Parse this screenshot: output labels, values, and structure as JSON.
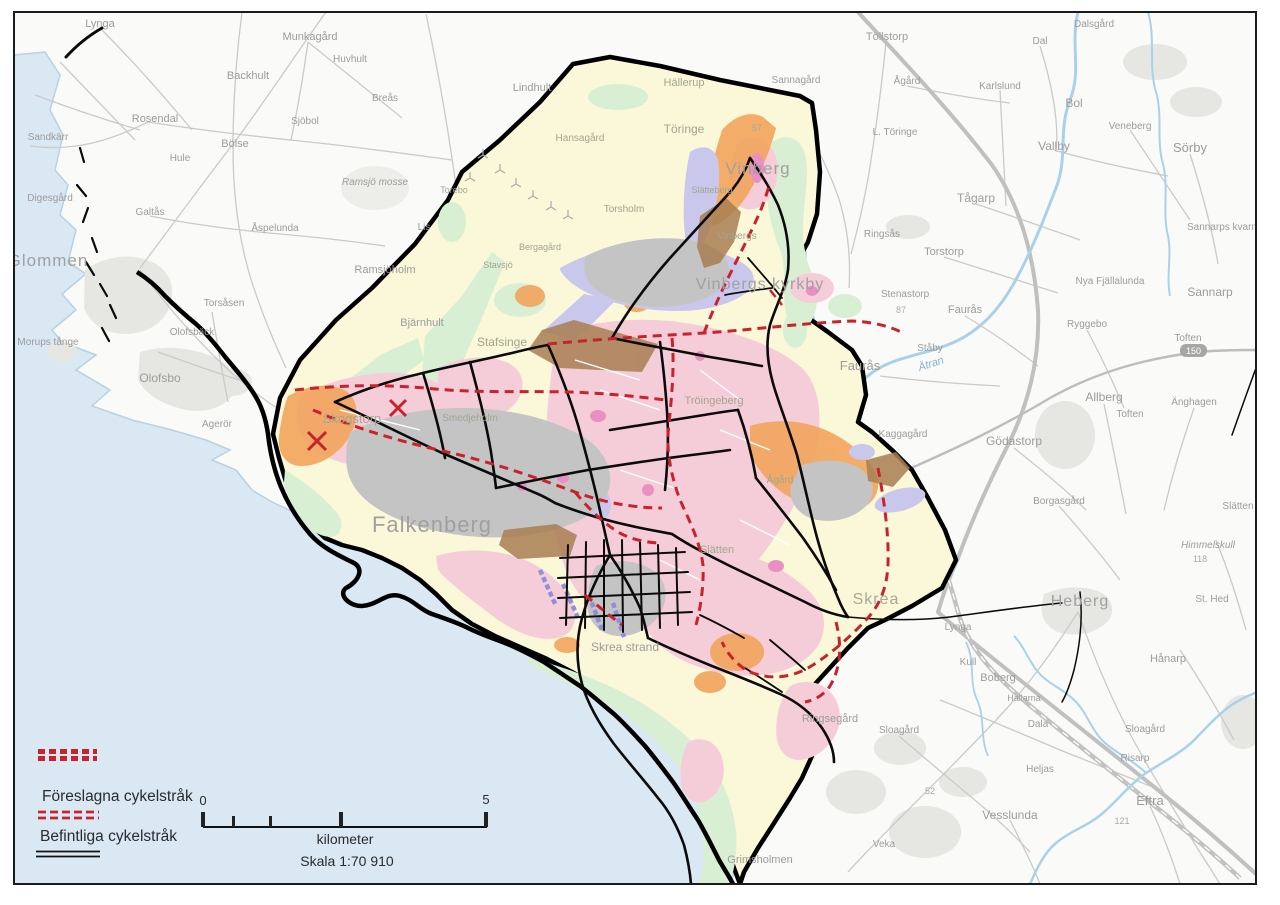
{
  "legend": {
    "items": [
      {
        "id": "proposed",
        "label": "Föreslagna cykelstråk"
      },
      {
        "id": "existing",
        "label": "Befintliga cykelstråk"
      }
    ]
  },
  "scalebar": {
    "start": "0",
    "end": "5",
    "unit": "kilometer",
    "scale": "Skala 1:70 910"
  },
  "road_shield": {
    "text": "150"
  },
  "colors": {
    "sea": "#d9e8f3",
    "coast": "#b7d2e3",
    "land": "#fafaf8",
    "planning_area": "#fbf7d9",
    "boundary": "#000000",
    "route_existing": "#0b0b0b",
    "route_proposed": "#c8232d",
    "pink_zone": "#f5cdd9",
    "magenta_zone": "#e98fc2",
    "green_zone": "#d9efd4",
    "orange_zone": "#f2a45c",
    "lavender_zone": "#c9c8ec",
    "gray_zone": "#c4c4c4",
    "brown_zone": "#a87e52",
    "river": "#a9d2e9",
    "road": "#cacaca",
    "road_major": "#bdbdbd",
    "urban": "#e6e6e3",
    "pier_violet": "#8f8ed8",
    "frame": "#1b1b1b"
  },
  "places": [
    {
      "t": "Lynga",
      "x": 100,
      "y": 27,
      "s": 11,
      "k": "out"
    },
    {
      "t": "Munkagård",
      "x": 310,
      "y": 40,
      "s": 11,
      "k": "out"
    },
    {
      "t": "Huvhult",
      "x": 350,
      "y": 62,
      "s": 10,
      "k": "out"
    },
    {
      "t": "Backhult",
      "x": 248,
      "y": 79,
      "s": 11,
      "k": "out"
    },
    {
      "t": "Breås",
      "x": 385,
      "y": 101,
      "s": 10,
      "k": "out"
    },
    {
      "t": "Lindhult",
      "x": 532,
      "y": 91,
      "s": 11,
      "k": "out"
    },
    {
      "t": "Rosendal",
      "x": 155,
      "y": 122,
      "s": 11,
      "k": "out"
    },
    {
      "t": "Sjöbol",
      "x": 305,
      "y": 124,
      "s": 10,
      "k": "out"
    },
    {
      "t": "Sandkärr",
      "x": 48,
      "y": 140,
      "s": 10,
      "k": "out"
    },
    {
      "t": "Bölse",
      "x": 235,
      "y": 147,
      "s": 11,
      "k": "out"
    },
    {
      "t": "Hule",
      "x": 180,
      "y": 161,
      "s": 10,
      "k": "out"
    },
    {
      "t": "Ramsjö mosse",
      "x": 375,
      "y": 185,
      "s": 10,
      "k": "out",
      "i": 1
    },
    {
      "t": "Digesgård",
      "x": 50,
      "y": 201,
      "s": 10,
      "k": "out"
    },
    {
      "t": "Galtås",
      "x": 150,
      "y": 215,
      "s": 10,
      "k": "out"
    },
    {
      "t": "Åspelunda",
      "x": 275,
      "y": 231,
      "s": 10,
      "k": "out"
    },
    {
      "t": "Glommen",
      "x": 48,
      "y": 266,
      "s": 17,
      "k": "big"
    },
    {
      "t": "Ramsjöholm",
      "x": 385,
      "y": 273,
      "s": 11,
      "k": "out"
    },
    {
      "t": "Lis",
      "x": 424,
      "y": 230,
      "s": 10,
      "k": "out"
    },
    {
      "t": "Torsåsen",
      "x": 224,
      "y": 306,
      "s": 10,
      "k": "out"
    },
    {
      "t": "Olofsbäck",
      "x": 192,
      "y": 335,
      "s": 10,
      "k": "out"
    },
    {
      "t": "Bjärnhult",
      "x": 422,
      "y": 326,
      "s": 11,
      "k": "out"
    },
    {
      "t": "Morups tånge",
      "x": 48,
      "y": 345,
      "s": 10,
      "k": "out"
    },
    {
      "t": "Olofsbo",
      "x": 160,
      "y": 382,
      "s": 12,
      "k": "out"
    },
    {
      "t": "Agerör",
      "x": 217,
      "y": 427,
      "s": 10,
      "k": "out"
    },
    {
      "t": "Töllstorp",
      "x": 887,
      "y": 40,
      "s": 11,
      "k": "out"
    },
    {
      "t": "Ågård",
      "x": 907,
      "y": 84,
      "s": 10,
      "k": "out"
    },
    {
      "t": "Dalsgård",
      "x": 1094,
      "y": 27,
      "s": 10,
      "k": "out"
    },
    {
      "t": "Dal",
      "x": 1040,
      "y": 44,
      "s": 10,
      "k": "out"
    },
    {
      "t": "Karlslund",
      "x": 1000,
      "y": 89,
      "s": 10,
      "k": "out"
    },
    {
      "t": "Bol",
      "x": 1074,
      "y": 107,
      "s": 12,
      "k": "out"
    },
    {
      "t": "L. Töringe",
      "x": 895,
      "y": 135,
      "s": 10,
      "k": "out"
    },
    {
      "t": "Vallby",
      "x": 1054,
      "y": 150,
      "s": 12,
      "k": "out"
    },
    {
      "t": "Veneberg",
      "x": 1130,
      "y": 129,
      "s": 10,
      "k": "out"
    },
    {
      "t": "Sörby",
      "x": 1190,
      "y": 152,
      "s": 13,
      "k": "out"
    },
    {
      "t": "Tågarp",
      "x": 976,
      "y": 202,
      "s": 12,
      "k": "out"
    },
    {
      "t": "Ringsås",
      "x": 882,
      "y": 237,
      "s": 10,
      "k": "out"
    },
    {
      "t": "Torstorp",
      "x": 944,
      "y": 255,
      "s": 11,
      "k": "out"
    },
    {
      "t": "Sannarps kvarn",
      "x": 1222,
      "y": 230,
      "s": 10,
      "k": "out"
    },
    {
      "t": "Sannarp",
      "x": 1210,
      "y": 296,
      "s": 12,
      "k": "out"
    },
    {
      "t": "Nya Fjällalunda",
      "x": 1110,
      "y": 284,
      "s": 10,
      "k": "out"
    },
    {
      "t": "Stenastorp",
      "x": 905,
      "y": 297,
      "s": 10,
      "k": "out"
    },
    {
      "t": "87",
      "x": 901,
      "y": 313,
      "s": 9,
      "k": "num"
    },
    {
      "t": "Faurås",
      "x": 965,
      "y": 313,
      "s": 11,
      "k": "out"
    },
    {
      "t": "Ståby",
      "x": 930,
      "y": 351,
      "s": 10,
      "k": "out"
    },
    {
      "t": "Faurås",
      "x": 860,
      "y": 370,
      "s": 13,
      "k": "out"
    },
    {
      "t": "Ryggebo",
      "x": 1087,
      "y": 327,
      "s": 10,
      "k": "out"
    },
    {
      "t": "Toften",
      "x": 1188,
      "y": 341,
      "s": 10,
      "k": "out"
    },
    {
      "t": "Ätran",
      "x": 932,
      "y": 367,
      "s": 11,
      "k": "riv",
      "r": -18
    },
    {
      "t": "Allberg",
      "x": 1104,
      "y": 401,
      "s": 12,
      "k": "out"
    },
    {
      "t": "Toften",
      "x": 1130,
      "y": 417,
      "s": 10,
      "k": "out"
    },
    {
      "t": "Änghagen",
      "x": 1194,
      "y": 405,
      "s": 10,
      "k": "out"
    },
    {
      "t": "Kaggagård",
      "x": 903,
      "y": 437,
      "s": 10,
      "k": "out"
    },
    {
      "t": "Gödastorp",
      "x": 1014,
      "y": 445,
      "s": 12,
      "k": "out"
    },
    {
      "t": "Borgasgård",
      "x": 1059,
      "y": 504,
      "s": 10,
      "k": "out"
    },
    {
      "t": "Slätten",
      "x": 1238,
      "y": 509,
      "s": 10,
      "k": "out"
    },
    {
      "t": "Himmelskull",
      "x": 1208,
      "y": 548,
      "s": 10,
      "k": "out",
      "i": 1
    },
    {
      "t": "118",
      "x": 1200,
      "y": 562,
      "s": 9,
      "k": "num"
    },
    {
      "t": "St. Hed",
      "x": 1212,
      "y": 602,
      "s": 10,
      "k": "out"
    },
    {
      "t": "Heberg",
      "x": 1080,
      "y": 606,
      "s": 16,
      "k": "big"
    },
    {
      "t": "Hånarp",
      "x": 1168,
      "y": 662,
      "s": 11,
      "k": "out"
    },
    {
      "t": "Lynga",
      "x": 958,
      "y": 630,
      "s": 10,
      "k": "out"
    },
    {
      "t": "Boberg",
      "x": 998,
      "y": 681,
      "s": 11,
      "k": "out"
    },
    {
      "t": "Hallarna",
      "x": 1024,
      "y": 701,
      "s": 9,
      "k": "out"
    },
    {
      "t": "Dala",
      "x": 1038,
      "y": 727,
      "s": 10,
      "k": "out"
    },
    {
      "t": "Sloagård",
      "x": 899,
      "y": 733,
      "s": 10,
      "k": "out"
    },
    {
      "t": "Sloagård",
      "x": 1145,
      "y": 732,
      "s": 10,
      "k": "out"
    },
    {
      "t": "Risarp",
      "x": 1135,
      "y": 761,
      "s": 10,
      "k": "out"
    },
    {
      "t": "Heljas",
      "x": 1040,
      "y": 772,
      "s": 10,
      "k": "out"
    },
    {
      "t": "Eftra",
      "x": 1150,
      "y": 805,
      "s": 13,
      "k": "out"
    },
    {
      "t": "Vesslunda",
      "x": 1010,
      "y": 819,
      "s": 12,
      "k": "out"
    },
    {
      "t": "Veka",
      "x": 884,
      "y": 847,
      "s": 10,
      "k": "out"
    },
    {
      "t": "121",
      "x": 1122,
      "y": 824,
      "s": 9,
      "k": "num"
    },
    {
      "t": "52",
      "x": 930,
      "y": 794,
      "s": 9,
      "k": "num"
    },
    {
      "t": "Grimsholmen",
      "x": 760,
      "y": 863,
      "s": 11,
      "k": "out"
    },
    {
      "t": "Kull",
      "x": 968,
      "y": 665,
      "s": 10,
      "k": "out"
    },
    {
      "t": "Skrea strand",
      "x": 625,
      "y": 651,
      "s": 12,
      "k": "out"
    },
    {
      "t": "Ringsegård",
      "x": 830,
      "y": 722,
      "s": 11,
      "k": "out"
    },
    {
      "t": "Hällerup",
      "x": 684,
      "y": 86,
      "s": 11,
      "k": "in"
    },
    {
      "t": "Sannagård",
      "x": 796,
      "y": 83,
      "s": 10,
      "k": "out"
    },
    {
      "t": "Töringe",
      "x": 684,
      "y": 133,
      "s": 12,
      "k": "in"
    },
    {
      "t": "Hansagård",
      "x": 580,
      "y": 141,
      "s": 10,
      "k": "in"
    },
    {
      "t": "Vinberg",
      "x": 758,
      "y": 174,
      "s": 17,
      "k": "big"
    },
    {
      "t": "57",
      "x": 757,
      "y": 131,
      "s": 9,
      "k": "num"
    },
    {
      "t": "Slätteberg",
      "x": 712,
      "y": 193,
      "s": 9,
      "k": "in"
    },
    {
      "t": "Torebo",
      "x": 454,
      "y": 193,
      "s": 9,
      "k": "in"
    },
    {
      "t": "Torsholm",
      "x": 624,
      "y": 212,
      "s": 10,
      "k": "in"
    },
    {
      "t": "Bergagård",
      "x": 540,
      "y": 250,
      "s": 9,
      "k": "in"
    },
    {
      "t": "Stavsjö",
      "x": 498,
      "y": 268,
      "s": 9,
      "k": "in"
    },
    {
      "t": "Vinbergs",
      "x": 737,
      "y": 239,
      "s": 10,
      "k": "in"
    },
    {
      "t": "Vinbergs kyrkby",
      "x": 760,
      "y": 289,
      "s": 16,
      "k": "big"
    },
    {
      "t": "Stafsinge",
      "x": 502,
      "y": 346,
      "s": 12,
      "k": "in"
    },
    {
      "t": "Smedjeholm",
      "x": 470,
      "y": 421,
      "s": 10,
      "k": "in"
    },
    {
      "t": "Skogstorp",
      "x": 352,
      "y": 423,
      "s": 13,
      "k": "in"
    },
    {
      "t": "Falkenberg",
      "x": 432,
      "y": 532,
      "s": 22,
      "k": "big"
    },
    {
      "t": "Tröingeberg",
      "x": 714,
      "y": 404,
      "s": 11,
      "k": "in"
    },
    {
      "t": "Ågård",
      "x": 780,
      "y": 483,
      "s": 10,
      "k": "in"
    },
    {
      "t": "Slätten",
      "x": 717,
      "y": 553,
      "s": 11,
      "k": "in"
    },
    {
      "t": "Skrea",
      "x": 876,
      "y": 604,
      "s": 16,
      "k": "bigin"
    }
  ]
}
